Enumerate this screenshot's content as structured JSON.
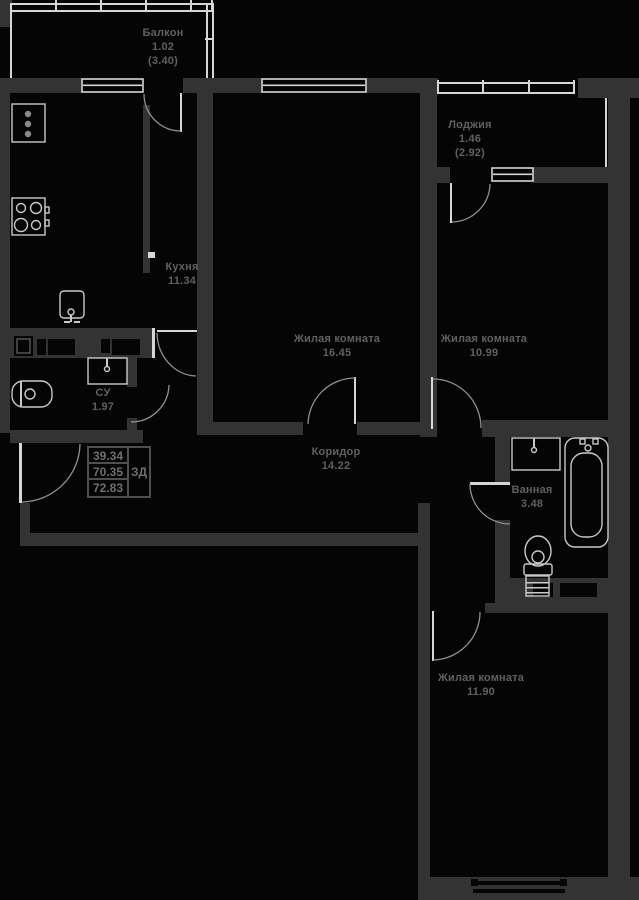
{
  "title": "Floor plan",
  "colors": {
    "bg": "#050505",
    "wall": "#333333",
    "line": "#d6d6d6",
    "fixture": "#c9c9c9",
    "arc": "#909090",
    "label": "#606060"
  },
  "rooms": {
    "balcony": {
      "name": "Балкон",
      "area": "1.02",
      "total": "(3.40)"
    },
    "loggia": {
      "name": "Лоджия",
      "area": "1.46",
      "total": "(2.92)"
    },
    "kitchen": {
      "name": "Кухня",
      "area": "11.34"
    },
    "living1": {
      "name": "Жилая комната",
      "area": "16.45"
    },
    "living2": {
      "name": "Жилая комната",
      "area": "10.99"
    },
    "corridor": {
      "name": "Коридор",
      "area": "14.22"
    },
    "su": {
      "name": "СУ",
      "area": "1.97"
    },
    "bathroom": {
      "name": "Ванная",
      "area": "3.48"
    },
    "living3": {
      "name": "Жилая комната",
      "area": "11.90"
    }
  },
  "info_table": {
    "r1": "39.34",
    "r2": "70.35",
    "r3": "72.83",
    "side": "ЗД"
  },
  "plan": {
    "walls": [
      [
        0,
        0,
        12,
        27
      ],
      [
        0,
        78,
        82,
        15
      ],
      [
        183,
        78,
        79,
        15
      ],
      [
        366,
        78,
        72,
        15
      ],
      [
        578,
        78,
        61,
        20
      ],
      [
        0,
        93,
        10,
        340
      ],
      [
        197,
        93,
        16,
        342
      ],
      [
        143,
        105,
        7,
        168
      ],
      [
        420,
        93,
        17,
        344
      ],
      [
        608,
        98,
        22,
        779
      ],
      [
        437,
        167,
        13,
        16
      ],
      [
        533,
        167,
        75,
        16
      ],
      [
        10,
        328,
        142,
        30
      ],
      [
        127,
        358,
        10,
        29
      ],
      [
        127,
        418,
        10,
        15
      ],
      [
        10,
        430,
        133,
        13
      ],
      [
        210,
        422,
        93,
        13
      ],
      [
        357,
        422,
        76,
        13
      ],
      [
        482,
        420,
        148,
        17
      ],
      [
        495,
        437,
        15,
        46
      ],
      [
        495,
        520,
        15,
        58
      ],
      [
        20,
        503,
        10,
        43
      ],
      [
        20,
        533,
        410,
        13
      ],
      [
        418,
        503,
        12,
        397
      ],
      [
        485,
        603,
        10,
        10
      ],
      [
        495,
        578,
        113,
        35
      ],
      [
        420,
        877,
        219,
        23
      ]
    ],
    "niches": [
      [
        14,
        336,
        19,
        20
      ],
      [
        37,
        339,
        9,
        16
      ],
      [
        48,
        339,
        27,
        16
      ],
      [
        101,
        339,
        9,
        14
      ],
      [
        112,
        339,
        28,
        16
      ],
      [
        533,
        583,
        20,
        14
      ],
      [
        560,
        583,
        37,
        14
      ],
      [
        471,
        879,
        7,
        7
      ],
      [
        560,
        879,
        7,
        7
      ],
      [
        473,
        881,
        92,
        4
      ],
      [
        473,
        889,
        92,
        4
      ]
    ],
    "lines": [
      [
        12,
        3,
        201,
        2
      ],
      [
        12,
        10,
        201,
        2
      ],
      [
        55,
        0,
        2,
        12
      ],
      [
        100,
        0,
        2,
        12
      ],
      [
        145,
        0,
        2,
        12
      ],
      [
        190,
        0,
        2,
        12
      ],
      [
        211,
        0,
        2,
        12
      ],
      [
        10,
        3,
        2,
        75
      ],
      [
        206,
        3,
        2,
        75
      ],
      [
        212,
        3,
        2,
        75
      ],
      [
        205,
        38,
        9,
        2
      ],
      [
        437,
        82,
        138,
        2
      ],
      [
        437,
        92,
        138,
        2
      ],
      [
        437,
        80,
        2,
        14
      ],
      [
        482,
        80,
        2,
        14
      ],
      [
        528,
        80,
        2,
        14
      ],
      [
        573,
        80,
        2,
        14
      ],
      [
        605,
        98,
        2,
        69
      ],
      [
        148,
        252,
        7,
        6
      ],
      [
        152,
        328,
        3,
        30
      ],
      [
        157,
        330,
        40,
        2
      ],
      [
        354,
        377,
        2,
        47
      ],
      [
        431,
        377,
        2,
        52
      ],
      [
        432,
        611,
        2,
        50
      ],
      [
        19,
        443,
        3,
        60
      ],
      [
        470,
        482,
        40,
        3
      ],
      [
        450,
        183,
        2,
        40
      ],
      [
        180,
        93,
        2,
        39
      ]
    ],
    "windows": [
      [
        82,
        79,
        61,
        13
      ],
      [
        262,
        79,
        104,
        13
      ],
      [
        492,
        168,
        41,
        13
      ]
    ],
    "arcs": [
      {
        "n": "balcony-door-arc",
        "d": "M144,94 A37,37 0 0 0 181,131"
      },
      {
        "n": "loggia-door-arc",
        "d": "M452,222 A39,39 0 0 0 490,184"
      },
      {
        "n": "kitchen-door-arc",
        "d": "M157,333 A40,44 0 0 0 196,376"
      },
      {
        "n": "su-door-arc",
        "d": "M131,422 A38,38 0 0 0 169,385"
      },
      {
        "n": "living1-door-arc",
        "d": "M308,424 A47,47 0 0 1 355,378"
      },
      {
        "n": "living2-door-arc",
        "d": "M433,379 A48,49 0 0 1 481,428"
      },
      {
        "n": "living3-door-arc",
        "d": "M433,660 A48,48 0 0 0 480,612"
      },
      {
        "n": "bathroom-door-arc",
        "d": "M470,484 A40,40 0 0 0 510,524"
      },
      {
        "n": "entrance-door-arc",
        "d": "M22,502 A59,59 0 0 0 80,444"
      }
    ],
    "fixtures": [
      {
        "n": "fridge",
        "t": "rect",
        "x": 12,
        "y": 104,
        "w": 33,
        "h": 38
      },
      {
        "n": "fridge-dot",
        "t": "circle",
        "cx": 28,
        "cy": 114,
        "r": 3.2,
        "f": 1,
        "c": "#8a8a8a"
      },
      {
        "n": "fridge-dot",
        "t": "circle",
        "cx": 28,
        "cy": 124,
        "r": 3.2,
        "f": 1,
        "c": "#8a8a8a"
      },
      {
        "n": "fridge-dot",
        "t": "circle",
        "cx": 28,
        "cy": 134,
        "r": 3.2,
        "f": 1,
        "c": "#8a8a8a"
      },
      {
        "n": "stove",
        "t": "rect",
        "x": 12,
        "y": 198,
        "w": 33,
        "h": 37
      },
      {
        "n": "stove-burner",
        "t": "circle",
        "cx": 21,
        "cy": 208,
        "r": 4.5
      },
      {
        "n": "stove-burner",
        "t": "circle",
        "cx": 36,
        "cy": 208,
        "r": 5.5
      },
      {
        "n": "stove-burner",
        "t": "circle",
        "cx": 21,
        "cy": 225,
        "r": 6.5
      },
      {
        "n": "stove-burner",
        "t": "circle",
        "cx": 36,
        "cy": 225,
        "r": 4.5
      },
      {
        "n": "stove-knob",
        "t": "rect",
        "x": 45,
        "y": 207,
        "w": 4,
        "h": 6
      },
      {
        "n": "stove-knob",
        "t": "rect",
        "x": 45,
        "y": 220,
        "w": 4,
        "h": 6
      },
      {
        "n": "kitchen-sink",
        "t": "rect",
        "x": 60,
        "y": 291,
        "w": 24,
        "h": 27,
        "rx": 4
      },
      {
        "n": "kitchen-sink-tap",
        "t": "circle",
        "cx": 71,
        "cy": 312,
        "r": 3
      },
      {
        "n": "kitchen-sink-tap",
        "t": "rect",
        "x": 70,
        "y": 315,
        "w": 2,
        "h": 7,
        "f": 1
      },
      {
        "n": "kitchen-sink-tap",
        "t": "rect",
        "x": 64,
        "y": 321,
        "w": 6,
        "h": 2,
        "f": 1
      },
      {
        "n": "kitchen-sink-tap",
        "t": "rect",
        "x": 74,
        "y": 321,
        "w": 6,
        "h": 2,
        "f": 1
      },
      {
        "n": "su-washbasin",
        "t": "rect",
        "x": 88,
        "y": 358,
        "w": 39,
        "h": 26
      },
      {
        "n": "su-washbasin-tap",
        "t": "rect",
        "x": 106,
        "y": 358,
        "w": 2,
        "h": 8,
        "f": 1
      },
      {
        "n": "su-washbasin-tap",
        "t": "circle",
        "cx": 107,
        "cy": 369,
        "r": 2.5
      },
      {
        "n": "su-toilet",
        "t": "rect",
        "x": 12,
        "y": 381,
        "w": 40,
        "h": 26,
        "rx": 11
      },
      {
        "n": "su-toilet-tank",
        "t": "rect",
        "x": 20,
        "y": 381,
        "w": 2,
        "h": 26,
        "f": 1
      },
      {
        "n": "su-toilet-bowl",
        "t": "circle",
        "cx": 30,
        "cy": 394,
        "r": 5
      },
      {
        "n": "bath-washbasin",
        "t": "rect",
        "x": 512,
        "y": 438,
        "w": 48,
        "h": 32
      },
      {
        "n": "bath-washbasin-tap",
        "t": "rect",
        "x": 533,
        "y": 438,
        "w": 2,
        "h": 9,
        "f": 1
      },
      {
        "n": "bath-washbasin-tap",
        "t": "circle",
        "cx": 534,
        "cy": 450,
        "r": 2.5
      },
      {
        "n": "bathtub",
        "t": "rect",
        "x": 565,
        "y": 438,
        "w": 43,
        "h": 109,
        "rx": 10
      },
      {
        "n": "bathtub-inner",
        "t": "rect",
        "x": 571,
        "y": 453,
        "w": 31,
        "h": 84,
        "rx": 13
      },
      {
        "n": "bathtub-tap",
        "t": "rect",
        "x": 580,
        "y": 439,
        "w": 5,
        "h": 5
      },
      {
        "n": "bathtub-tap",
        "t": "rect",
        "x": 593,
        "y": 439,
        "w": 5,
        "h": 5
      },
      {
        "n": "bathtub-tap",
        "t": "circle",
        "cx": 588,
        "cy": 448,
        "r": 3
      },
      {
        "n": "bath-toilet-bowl",
        "t": "ellipse",
        "cx": 538,
        "cy": 551,
        "rx": 13,
        "ry": 15
      },
      {
        "n": "bath-toilet-seat",
        "t": "circle",
        "cx": 538,
        "cy": 557,
        "r": 6
      },
      {
        "n": "bath-toilet-tank",
        "t": "rect",
        "x": 524,
        "y": 564,
        "w": 28,
        "h": 11,
        "rx": 2
      },
      {
        "n": "shaft-hatch",
        "t": "rect",
        "x": 526,
        "y": 576,
        "w": 23,
        "h": 20
      },
      {
        "n": "shaft-hatch-line",
        "t": "rect",
        "x": 526,
        "y": 582,
        "w": 23,
        "h": 1.5,
        "f": 1
      },
      {
        "n": "shaft-hatch-line",
        "t": "rect",
        "x": 526,
        "y": 587,
        "w": 23,
        "h": 1.5,
        "f": 1
      },
      {
        "n": "shaft-hatch-line",
        "t": "rect",
        "x": 526,
        "y": 592,
        "w": 23,
        "h": 1.5,
        "f": 1
      },
      {
        "n": "duct-box",
        "t": "rect",
        "x": 17,
        "y": 339,
        "w": 13,
        "h": 14,
        "c": "#5a5a5a"
      }
    ]
  }
}
